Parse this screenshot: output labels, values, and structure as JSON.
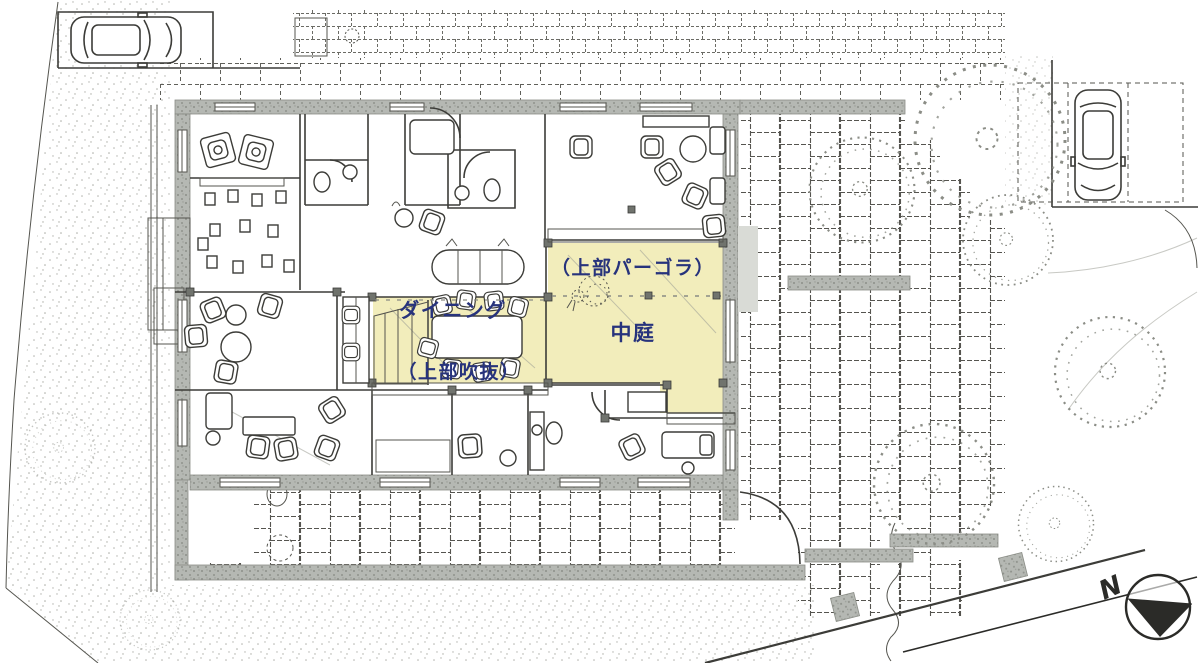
{
  "plan": {
    "areas": {
      "dining": {
        "label": "ダイニング",
        "note": "（上部吹抜）"
      },
      "courtyard": {
        "label": "中庭",
        "note": "（上部パーゴラ）"
      }
    },
    "compass": {
      "label": "N"
    },
    "colors": {
      "highlight": "#f2edbb",
      "label_text": "#27337c",
      "wall": "#b5b8b3",
      "ink": "#3c3c38",
      "paper": "#ffffff"
    },
    "icons": {
      "north_arrow": "north-arrow-icon",
      "car": "car-icon",
      "tree": "tree-icon"
    }
  }
}
